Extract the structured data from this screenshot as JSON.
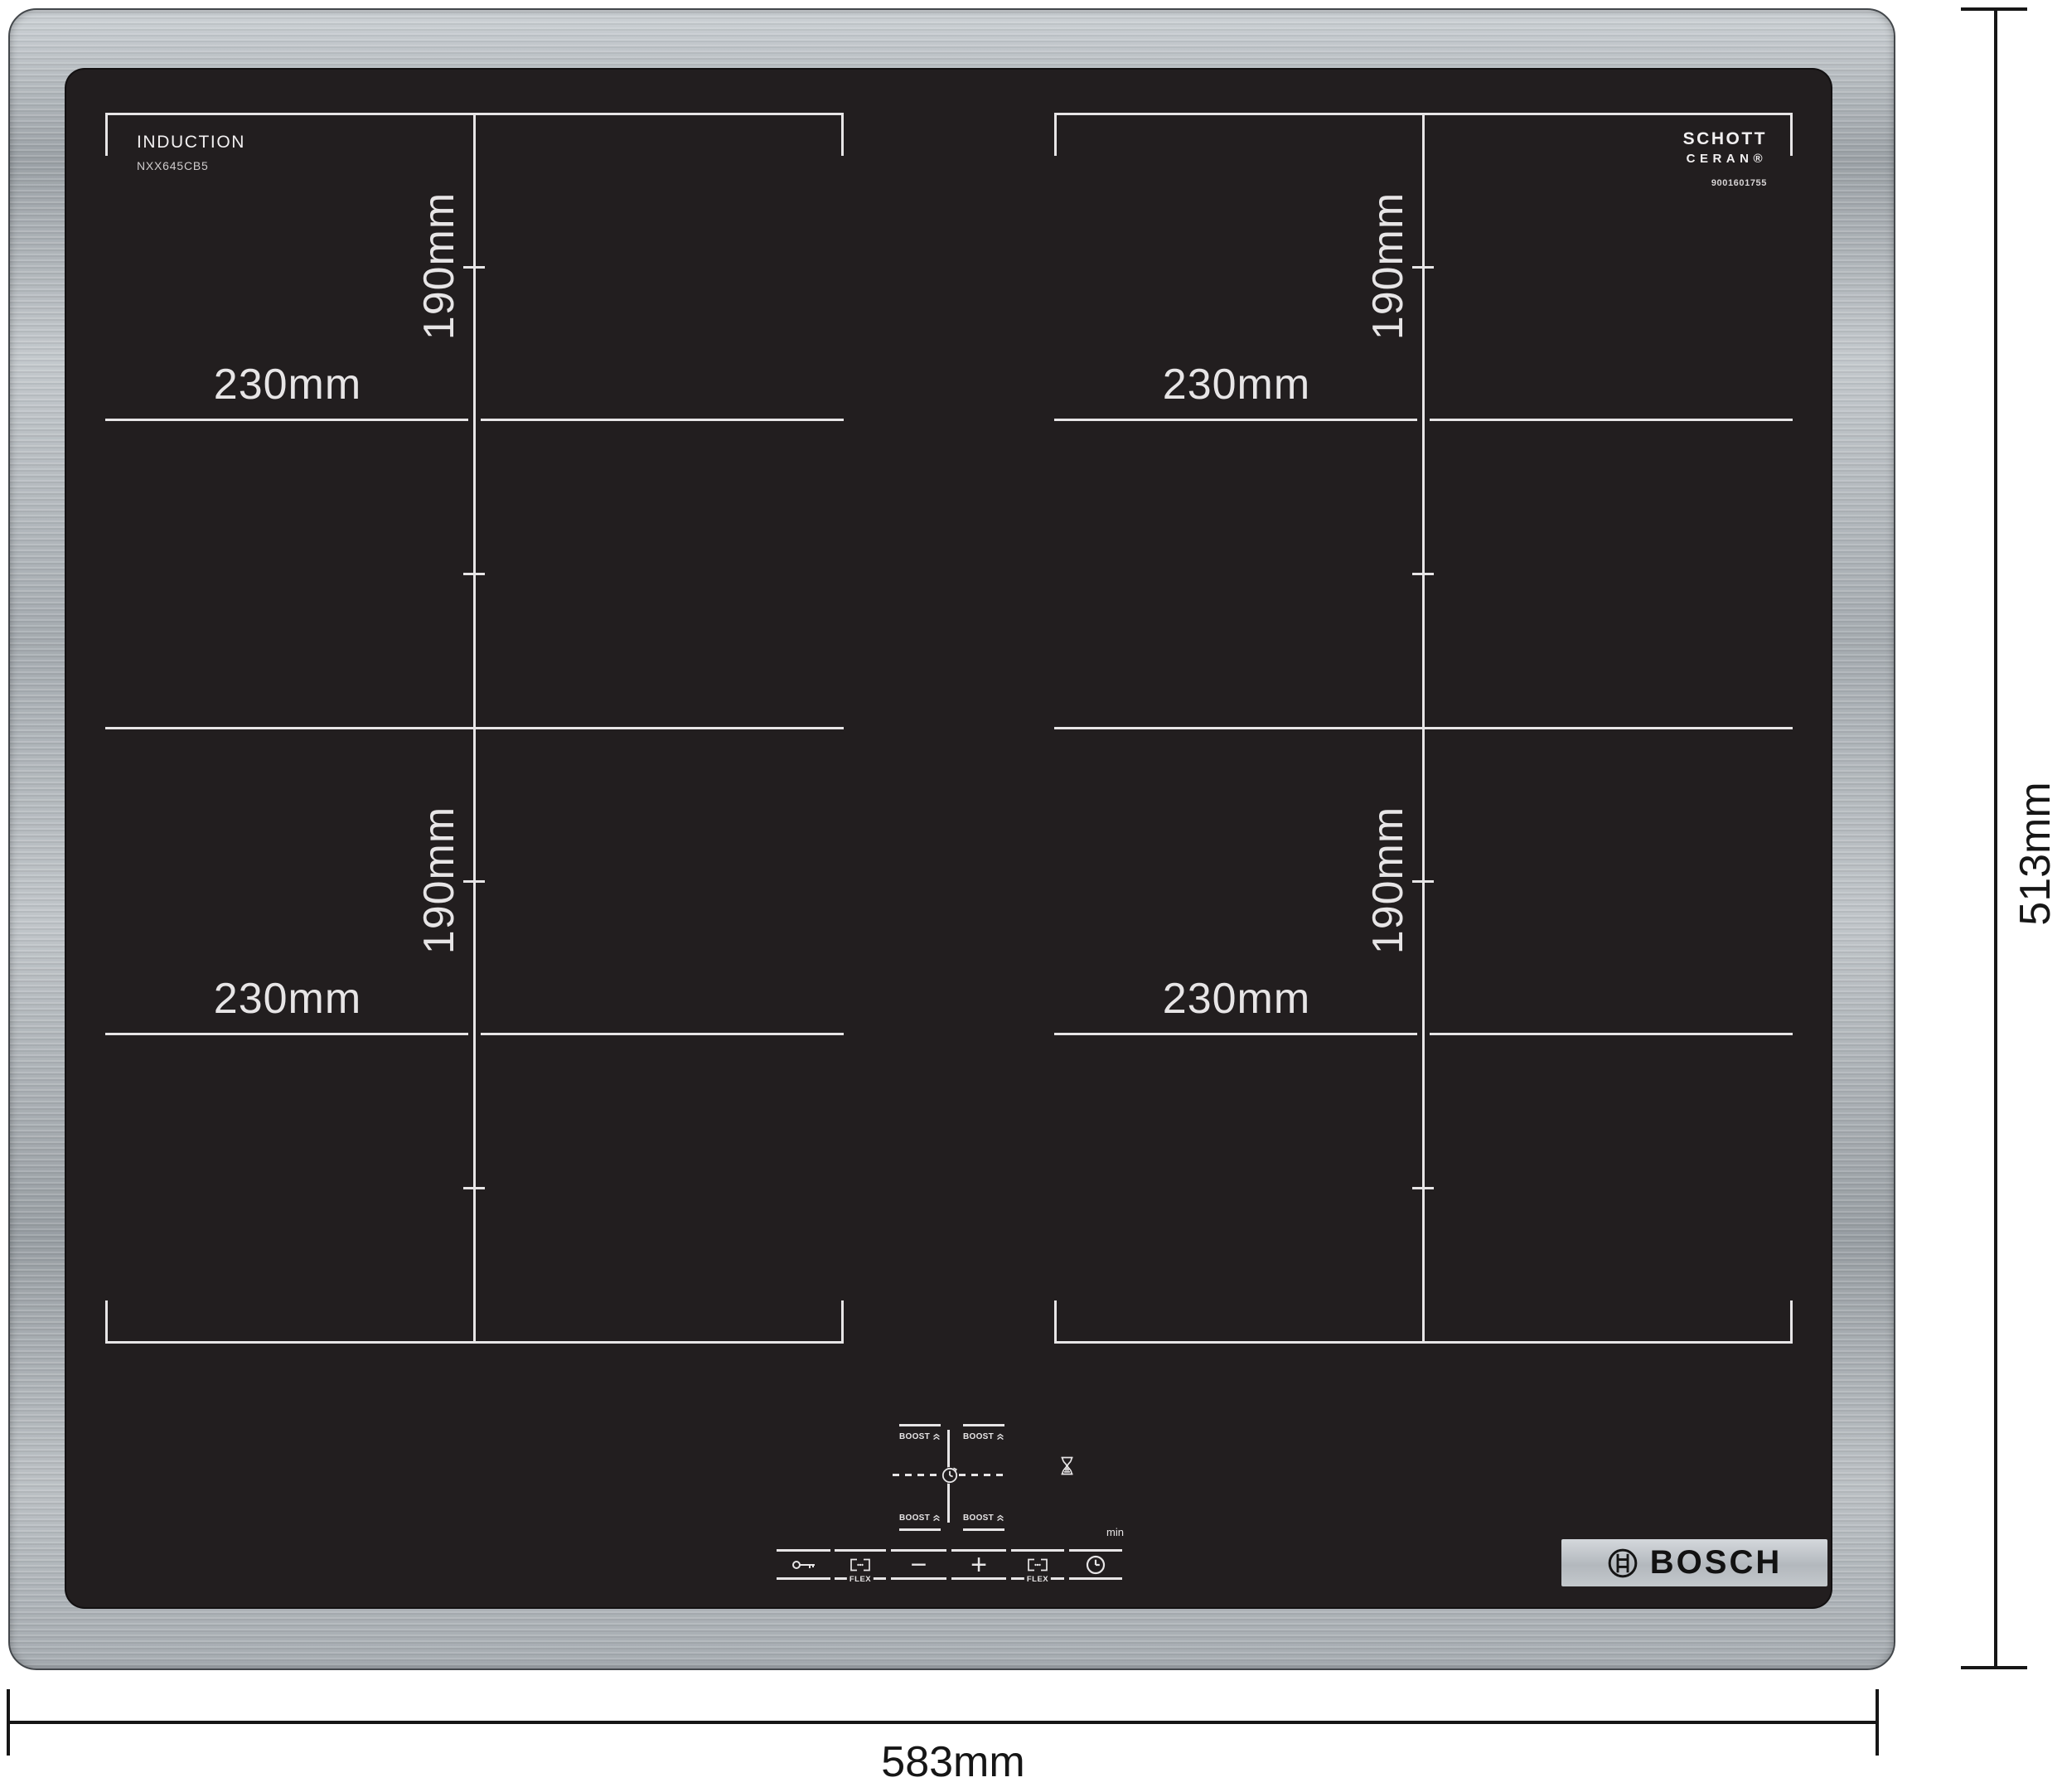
{
  "product": {
    "surface_label": "INDUCTION",
    "model": "NXX645CB5",
    "glass_brand": {
      "line1": "SCHOTT",
      "line2": "CERAN®",
      "serial": "9001601755"
    },
    "brand": "BOSCH"
  },
  "dimensions": {
    "overall_width": "583mm",
    "overall_height": "513mm"
  },
  "zones": [
    {
      "position": "top-left",
      "width_label": "230mm",
      "height_label": "190mm"
    },
    {
      "position": "bottom-left",
      "width_label": "230mm",
      "height_label": "190mm"
    },
    {
      "position": "top-right",
      "width_label": "230mm",
      "height_label": "190mm"
    },
    {
      "position": "bottom-right",
      "width_label": "230mm",
      "height_label": "190mm"
    }
  ],
  "controls": {
    "boost_label": "BOOST",
    "flex_label": "FLEX",
    "minutes_label": "min",
    "minus_label": "−",
    "plus_label": "+",
    "icons": {
      "child_lock": "key-icon",
      "flex_zone": "flex-bracket-icon",
      "timer": "clock-icon",
      "zone_timer": "timer-clock-icon",
      "hourglass": "hourglass-icon",
      "boost": "double-chevron-up-icon"
    }
  },
  "colors": {
    "glass": "#221e1f",
    "zone_line": "#e7e5e6",
    "steel": "#b3b9bd",
    "dimension": "#161616",
    "logo_plate": "#b9bec2"
  }
}
